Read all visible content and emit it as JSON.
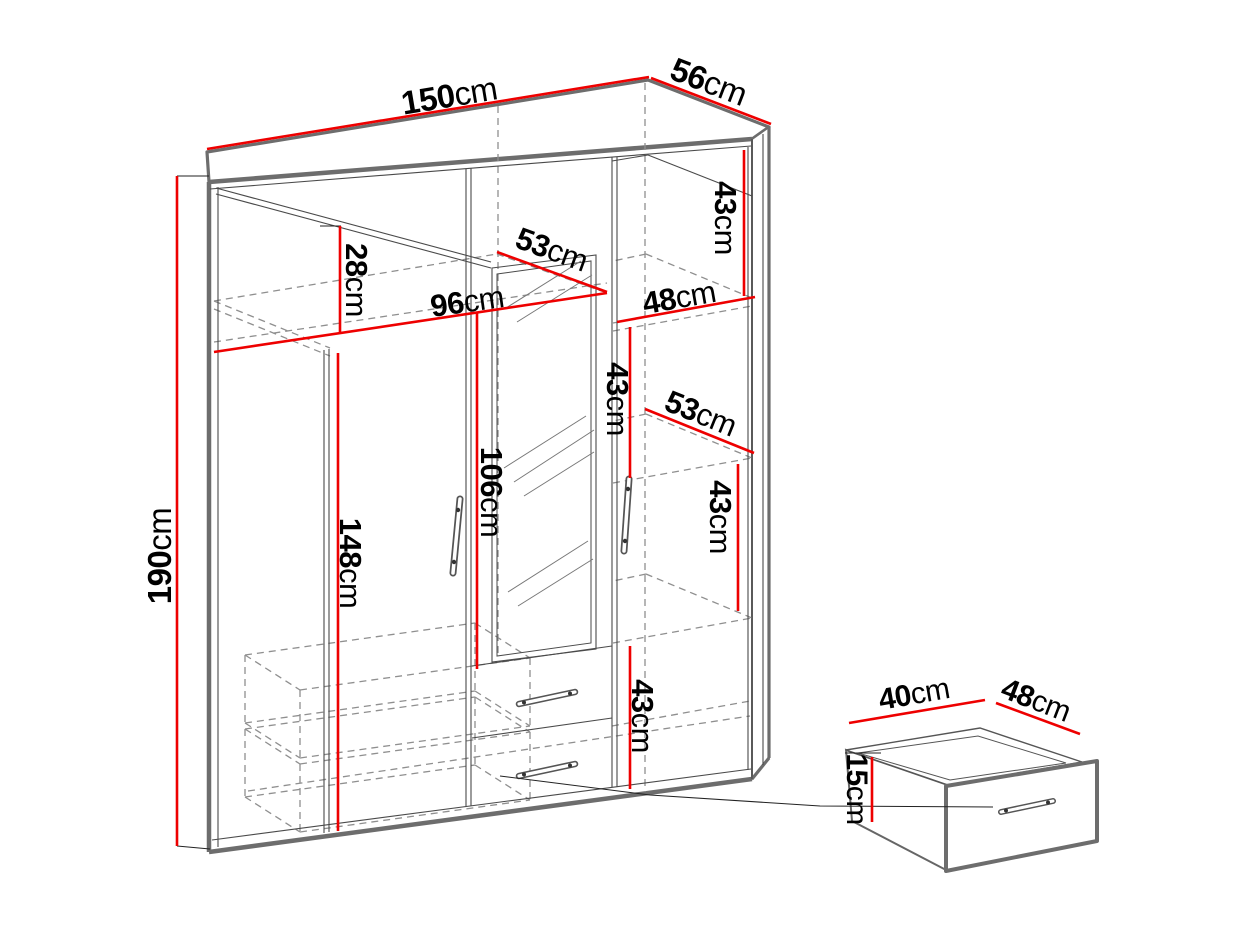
{
  "diagram_title": "wardrobe-dimension-diagram",
  "unit": "cm",
  "colors": {
    "dimension_line": "#ee0000",
    "outline": "#6d6d6d",
    "thin_line": "#4a4a4a",
    "hidden_line": "#8f8f8f",
    "text": "#000000",
    "background": "#ffffff"
  },
  "labels": [
    {
      "name": "top-width",
      "num": "150",
      "unit": "cm"
    },
    {
      "name": "top-depth",
      "num": "56",
      "unit": "cm"
    },
    {
      "name": "overall-height",
      "num": "190",
      "unit": "cm"
    },
    {
      "name": "top-shelf-height",
      "num": "28",
      "unit": "cm"
    },
    {
      "name": "left-interior-width",
      "num": "96",
      "unit": "cm"
    },
    {
      "name": "shelf-depth-upper",
      "num": "53",
      "unit": "cm"
    },
    {
      "name": "right-interior-width",
      "num": "48",
      "unit": "cm"
    },
    {
      "name": "right-cubby-1-height",
      "num": "43",
      "unit": "cm"
    },
    {
      "name": "right-cubby-2-height",
      "num": "43",
      "unit": "cm"
    },
    {
      "name": "shelf-depth-middle",
      "num": "53",
      "unit": "cm"
    },
    {
      "name": "right-cubby-3-height",
      "num": "43",
      "unit": "cm"
    },
    {
      "name": "mirror-height",
      "num": "106",
      "unit": "cm"
    },
    {
      "name": "left-interior-height",
      "num": "148",
      "unit": "cm"
    },
    {
      "name": "right-cubby-4-height",
      "num": "43",
      "unit": "cm"
    },
    {
      "name": "drawer-width",
      "num": "40",
      "unit": "cm"
    },
    {
      "name": "drawer-depth",
      "num": "48",
      "unit": "cm"
    },
    {
      "name": "drawer-height",
      "num": "15",
      "unit": "cm"
    }
  ]
}
